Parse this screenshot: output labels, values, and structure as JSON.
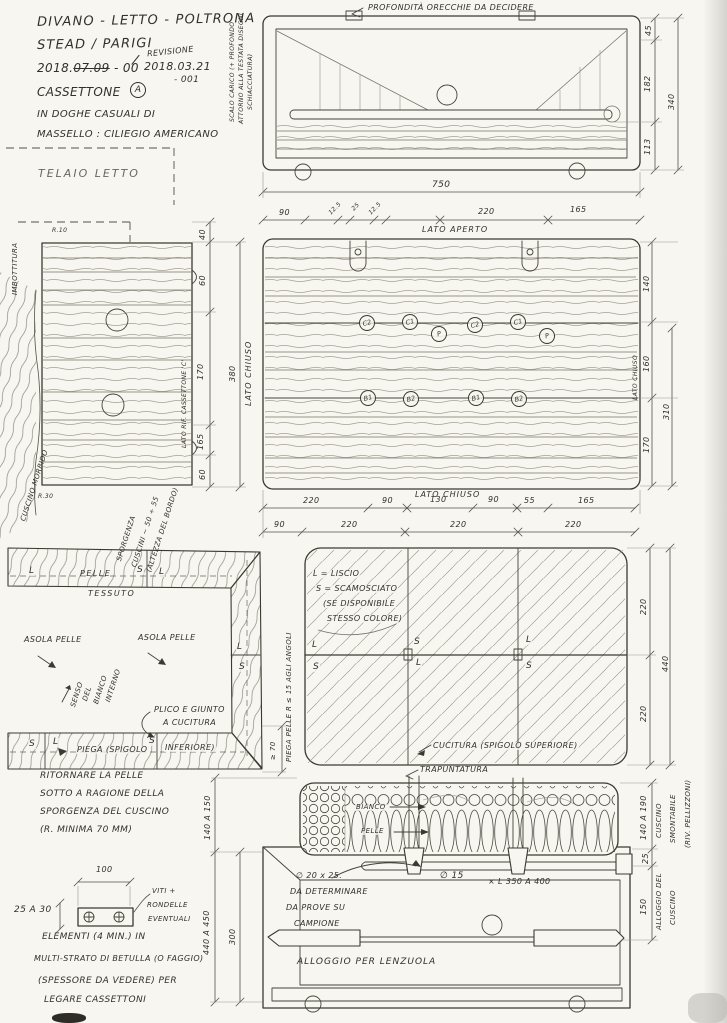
{
  "title_block": {
    "line1": "DIVANO - LETTO - POLTRONA",
    "line2": "STEAD / PARIGI",
    "year": "2018.",
    "date_struck": "07.09",
    "rev0": "- 00",
    "slash": "/",
    "revisione_label": "REVISIONE",
    "rev_date": "2018.03.21",
    "rev_num": "- 001",
    "item": "CASSETTONE",
    "item_badge": "A",
    "note1": "IN DOGHE CASUALI DI",
    "note2": "MASSELLO : CILIEGIO AMERICANO",
    "telaio": "TELAIO LETTO",
    "side_note1": "SCALO CARICO (+ PROFONDO",
    "side_note2": "ATTORNO ALLA TESTATA DISEGNI",
    "side_note3": "SCHIACCIATURA)"
  },
  "front_view": {
    "top_note": "PROFONDITÀ ORECCHIE DA DECIDERE",
    "dim_45": "45",
    "dim_182": "182",
    "dim_113": "113",
    "dim_340": "340",
    "dim_750": "750",
    "dims_row": [
      "90",
      "12.5",
      "25",
      "12.5",
      "220",
      "165"
    ]
  },
  "plan_view": {
    "lato_aperto": "LATO APERTO",
    "lato_chiuso_left": "LATO CHIUSO",
    "lato_chiuso_right": "LATO CHIUSO",
    "lato_chiuso_bottom": "LATO CHIUSO",
    "fittings_top": [
      "C2",
      "C1",
      "P",
      "C2",
      "C1",
      "P"
    ],
    "fittings_bottom": [
      "B1",
      "B2",
      "B1",
      "B2"
    ],
    "dim_140": "140",
    "dim_160": "160",
    "dim_170": "170",
    "dim_310": "310",
    "dims_row1": [
      "220",
      "90",
      "130",
      "90",
      "55",
      "165"
    ],
    "dims_row2": [
      "90",
      "220",
      "220",
      "220"
    ]
  },
  "side_panel": {
    "imbottitura": "IMBOTTITURA",
    "cuscino": "CUSCINO MORBIDO",
    "r_top": "R.10",
    "r_bottom": "R.30",
    "ref": "LATO RIF. CASSETTONE 'C'",
    "dims": [
      "40",
      "60",
      "170",
      "165",
      "60"
    ],
    "dim_total": "380",
    "sporgenza1": "SPORGENZA",
    "sporgenza2": "CUSCINI ~ 50 ÷ 55",
    "sporgenza3": "(ALTEZZA DEL BORDO)"
  },
  "corner_detail": {
    "pelle": "PELLE",
    "tessuto": "TESSUTO",
    "asola1": "ASOLA PELLE",
    "asola2": "ASOLA PELLE",
    "senso1": "SENSO",
    "senso2": "DEL",
    "senso3": "BIANCO",
    "senso4": "INTERNO",
    "plico1": "PLICO E GIUNTO",
    "plico2": "A CUCITURA",
    "piega1": "PIEGA (SPIGOLO",
    "piega2": "INFERIORE)",
    "lt1": "L",
    "lt2": "S",
    "lt3": "L",
    "lt4": "L",
    "lt5": "S",
    "lt6": "S",
    "lt7": "L",
    "lt8": "S",
    "piega_pelle": "PIEGA PELLE R ≤ 15 AGLI ANGOLI",
    "dim_70": "≥ 70",
    "note1": "RITORNARE LA PELLE",
    "note2": "SOTTO A RAGIONE DELLA",
    "note3": "SPORGENZA DEL CUSCINO",
    "note4": "(R. MINIMA 70 MM)"
  },
  "cushion_plan": {
    "legend1": "L = LISCIO",
    "legend2": "S = SCAMOSCIATO",
    "legend3": "(SE DISPONIBILE",
    "legend4": "STESSO COLORE)",
    "lt1": "L",
    "lt2": "S",
    "lt3": "L",
    "lt4": "S",
    "lt5": "L",
    "lt6": "S",
    "cucitura": "CUCITURA (SPIGOLO SUPERIORE)",
    "dim_220a": "220",
    "dim_220b": "220",
    "dim_440": "440"
  },
  "section_view": {
    "trapuntatura": "TRAPUNTATURA",
    "bianco": "BIANCO",
    "pelle": "PELLE",
    "note1": "∅ 20 x 25.",
    "note2": "DA DETERMINARE",
    "note3": "DA PROVE SU",
    "note4": "CAMPIONE",
    "bolt1": "∅ 15",
    "bolt2": "× L 350 A 400",
    "alloggio": "ALLOGGIO PER LENZUOLA",
    "dim_140_150": "140 A 150",
    "dim_440_450": "440 A 450",
    "dim_300": "300",
    "dim_140_190": "140 A 190",
    "dim_25": "25",
    "dim_150": "150",
    "cuscino1": "CUSCINO",
    "cuscino2": "SMONTABILE",
    "cuscino3": "(RIV. PELLIZZONI)",
    "alloggio_cuscino1": "ALLOGGIO DEL",
    "alloggio_cuscino2": "CUSCINO"
  },
  "plate_detail": {
    "dim_100": "100",
    "dim_25_30": "25 A 30",
    "viti1": "VITI +",
    "viti2": "RONDELLE",
    "viti3": "EVENTUALI",
    "note1": "ELEMENTI (4 MIN.) IN",
    "note2": "MULTI-STRATO DI BETULLA (O FAGGIO)",
    "note3": "(SPESSORE DA VEDERE) PER",
    "note4": "LEGARE CASSETTONI"
  }
}
